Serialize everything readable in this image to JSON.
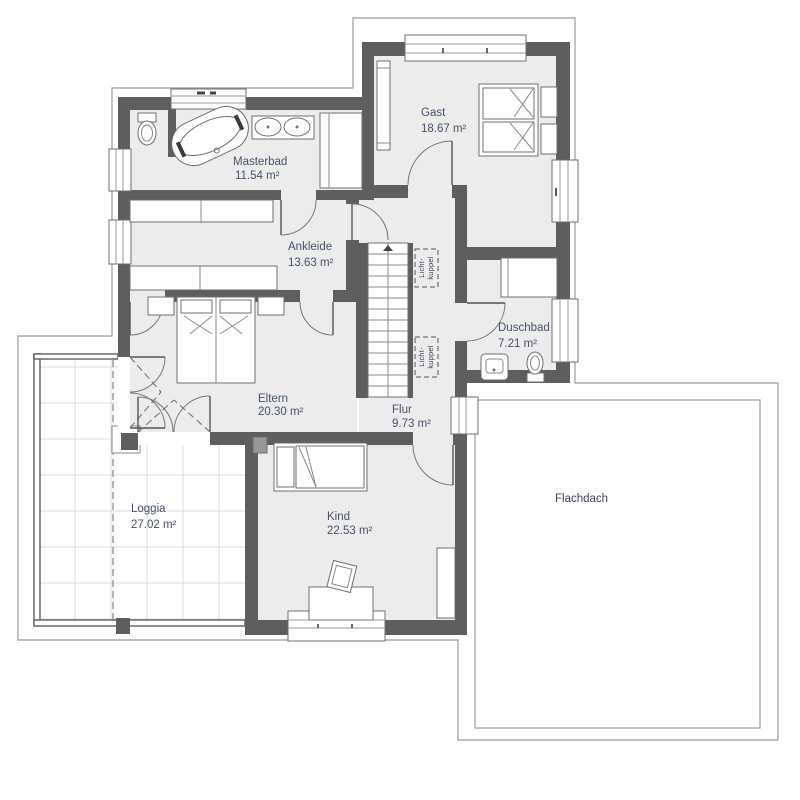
{
  "plan_type": "floor-plan",
  "rooms": {
    "masterbad": {
      "name": "Masterbad",
      "area": "11.54 m²"
    },
    "gast": {
      "name": "Gast",
      "area": "18.67 m²"
    },
    "ankleide": {
      "name": "Ankleide",
      "area": "13.63 m²"
    },
    "eltern": {
      "name": "Eltern",
      "area": "20.30 m²"
    },
    "duschbad": {
      "name": "Duschbad",
      "area": "7.21 m²"
    },
    "flur": {
      "name": "Flur",
      "area": "9.73 m²"
    },
    "kind": {
      "name": "Kind",
      "area": "22.53 m²"
    },
    "loggia": {
      "name": "Loggia",
      "area": "27.02 m²"
    },
    "flachdach": {
      "name": "Flachdach",
      "area": ""
    }
  },
  "annotations": {
    "skylight": {
      "line1": "Licht-",
      "line2": "kuppel"
    }
  },
  "colors": {
    "wall": "#5e5e5e",
    "floor": "#ececec",
    "label_text": "#46516b",
    "outline": "#9b9b9b",
    "background": "#ffffff"
  }
}
